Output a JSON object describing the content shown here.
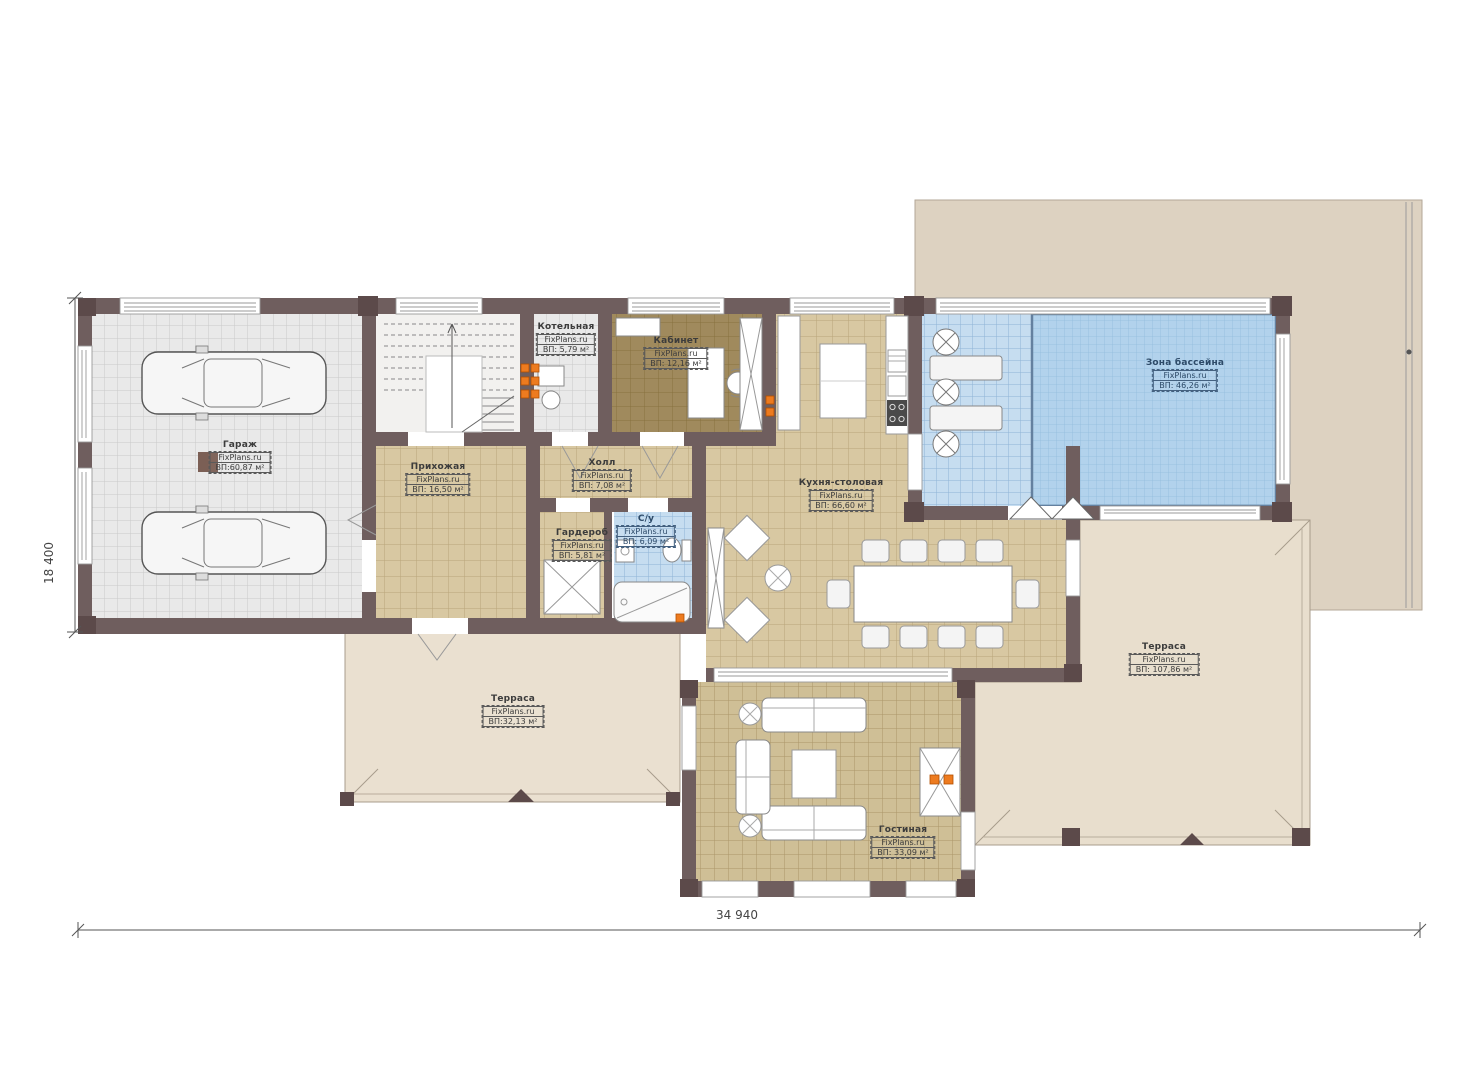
{
  "plan": {
    "brand": "FixPlans.ru",
    "dimensions": {
      "width": "34 940",
      "height": "18 400"
    },
    "rooms": {
      "garage": {
        "name": "Гараж",
        "area": "ВП:60,87 м²"
      },
      "boiler": {
        "name": "Котельная",
        "area": "ВП: 5,79 м²"
      },
      "office": {
        "name": "Кабинет",
        "area": "ВП: 12,16 м²"
      },
      "hallway": {
        "name": "Прихожая",
        "area": "ВП: 16,50 м²"
      },
      "hall": {
        "name": "Холл",
        "area": "ВП: 7,08 м²"
      },
      "bathroom": {
        "name": "С/у",
        "area": "ВП: 6,09 м²"
      },
      "wardrobe": {
        "name": "Гардероб",
        "area": "ВП: 5,81 м²"
      },
      "kitchen_dining": {
        "name": "Кухня-столовая",
        "area": "ВП: 66,60 м²"
      },
      "pool_zone": {
        "name": "Зона бассейна",
        "area": "ВП: 46,26 м²"
      },
      "terrace_left": {
        "name": "Терраса",
        "area": "ВП:32,13 м²"
      },
      "terrace_right": {
        "name": "Терраса",
        "area": "ВП: 107,86 м²"
      },
      "living_room": {
        "name": "Гостиная",
        "area": "ВП: 33,09 м²"
      }
    },
    "colors": {
      "wall": "#6f5e5e",
      "roof": "#ddd2c1",
      "terrace": "#e8decd",
      "tile_beige": "#d8c8a2",
      "tile_blue": "#c6ddf0",
      "pool_water": "#b2d2ec",
      "heat_dot": "#ed7b1f"
    }
  }
}
